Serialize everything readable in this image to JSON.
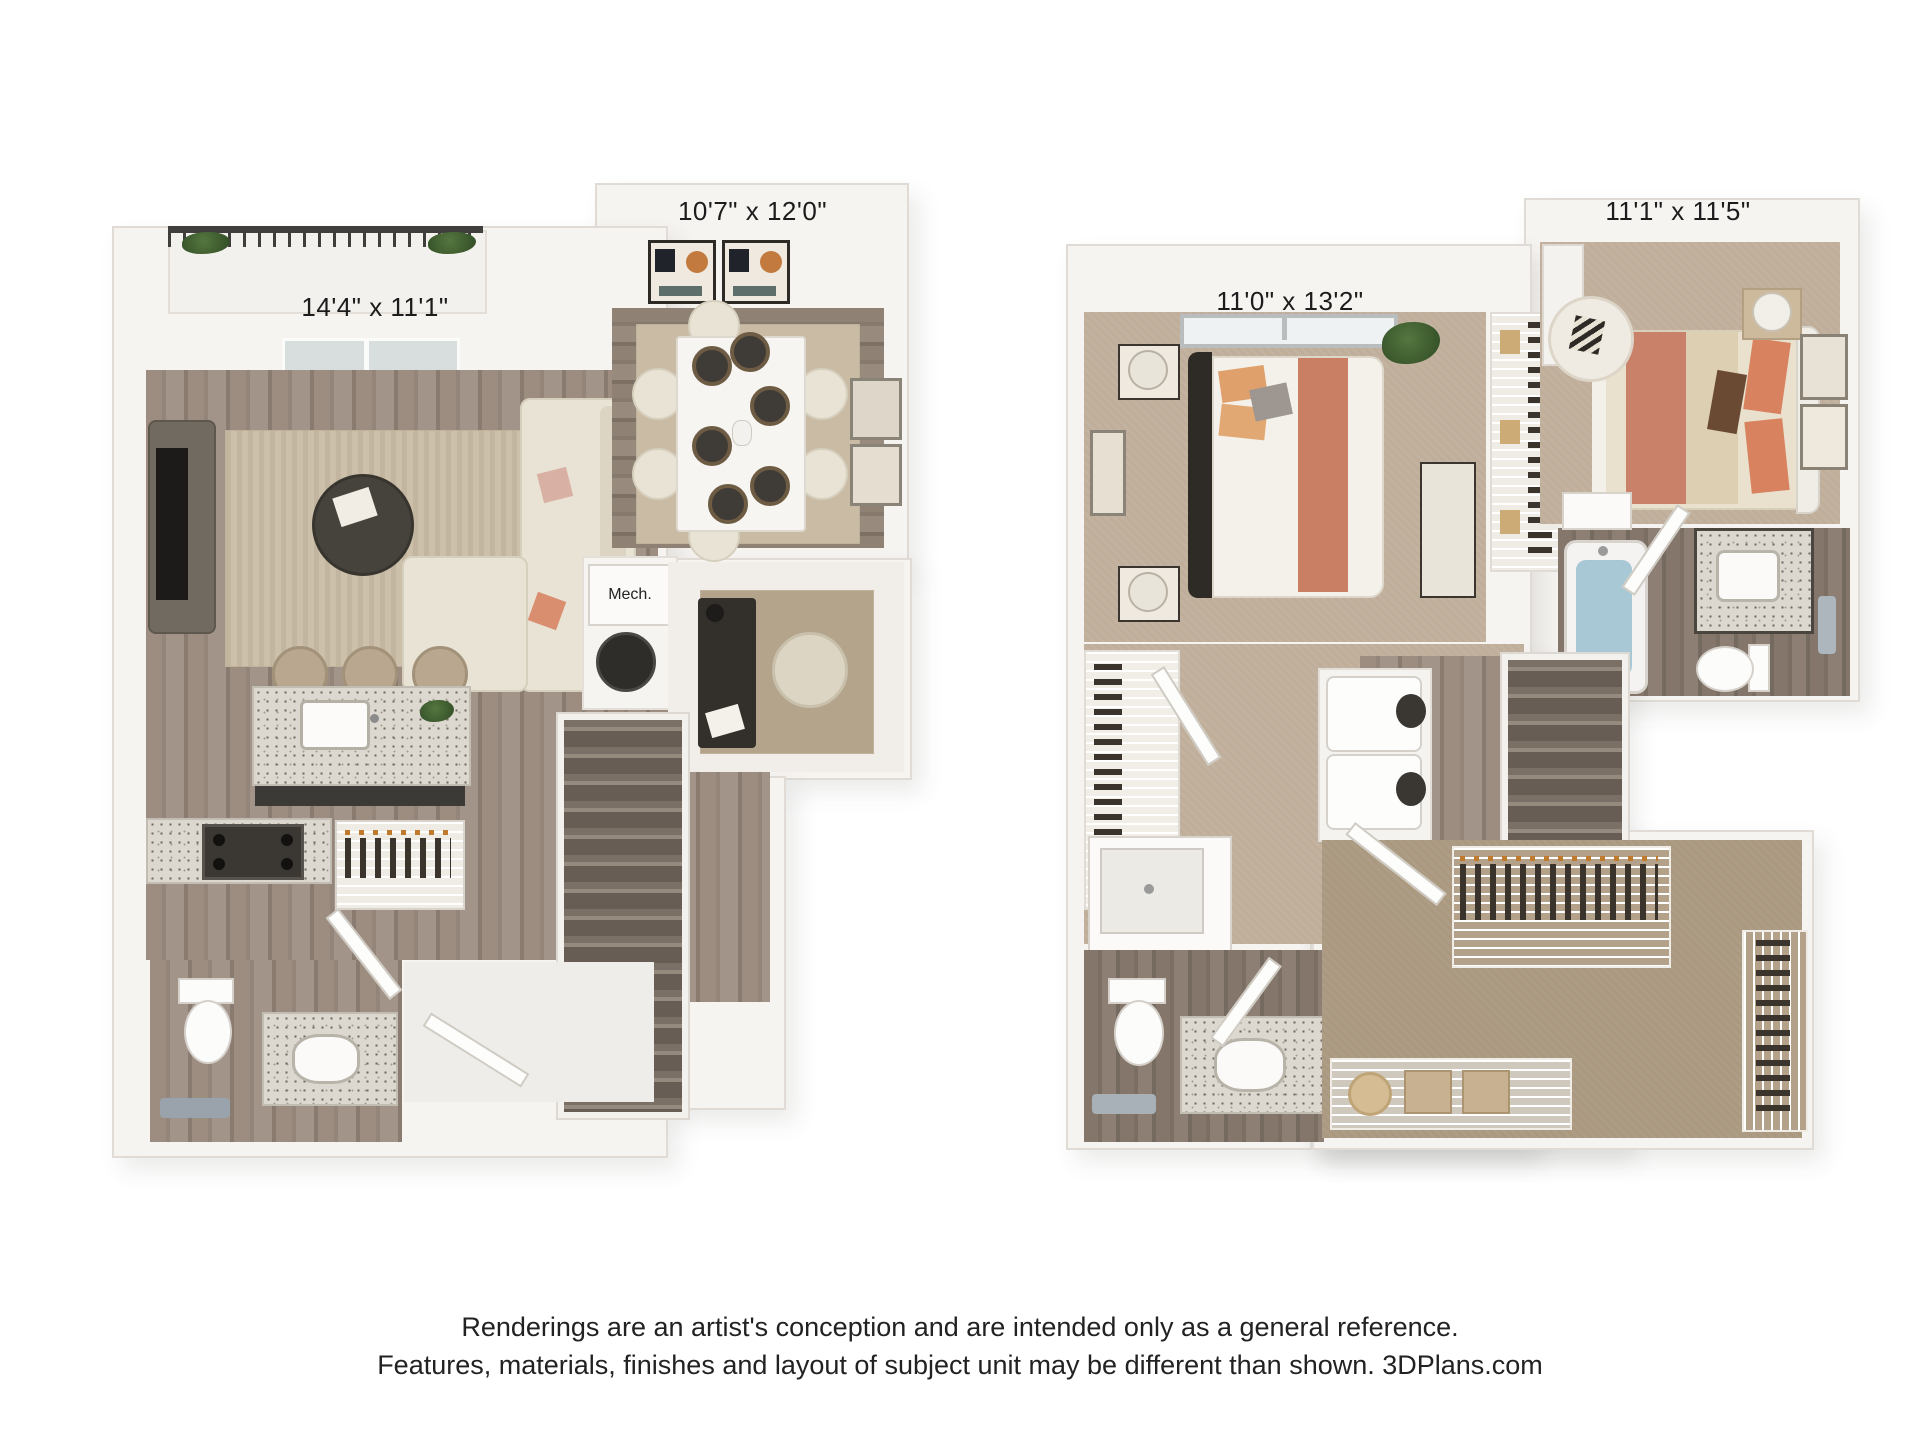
{
  "floor1": {
    "living_dims": "14'4\" x 11'1\"",
    "dining_dims": "10'7\" x 12'0\"",
    "mech_label": "Mech."
  },
  "floor2": {
    "bedroom1_dims": "11'0\" x 13'2\"",
    "bedroom2_dims": "11'1\" x 11'5\""
  },
  "disclaimer": {
    "line1": "Renderings are an artist's conception and are intended only as a general reference.",
    "line2": "Features, materials, finishes and layout of subject unit may be different than shown. 3DPlans.com"
  },
  "colors": {
    "wall": "#f5f3ef",
    "wood_floor": "#95877b",
    "carpet": "#bfae99",
    "accent_coral": "#c97f62",
    "accent_orange": "#e0a06c",
    "tub_water": "#a9c8d5",
    "stair_tread": "#7b7066"
  }
}
